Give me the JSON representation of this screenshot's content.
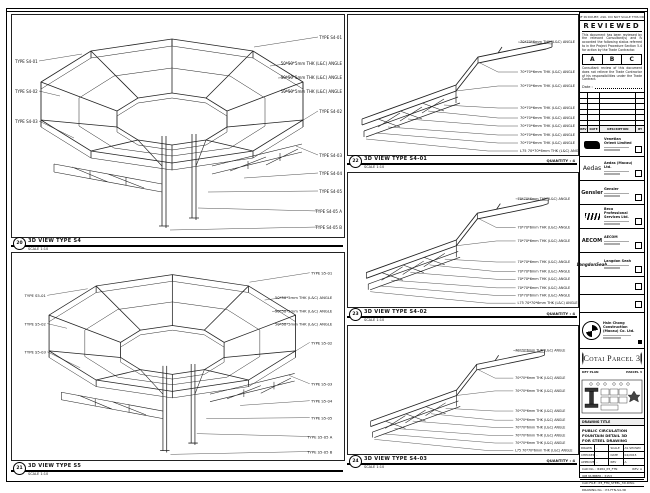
{
  "sheet": {
    "top_note": "IF IN DOUBT, ASK. DO NOT SCALE THIS DRAWING. ALL DIMENSIONS ARE IN MILLIMETRES."
  },
  "views": {
    "s4": {
      "ref": "20",
      "title": "3D VIEW TYPE S4",
      "scale": "SCALE 1:10",
      "left_labels": [
        "TYPE S4-01",
        "TYPE S4-02",
        "TYPE S4-03"
      ],
      "right_labels": [
        "TYPE S4-01",
        "50*50*5mm THK (L&C) ANGLE",
        "50*50*5mm THK (L&C) ANGLE",
        "50*50*5mm THK (L&C) ANGLE",
        "TYPE S4-02",
        "TYPE S4-03",
        "TYPE S4-04",
        "TYPE S4-05",
        "TYPE S4-05 A",
        "TYPE S4-05 B"
      ]
    },
    "s5": {
      "ref": "21",
      "title": "3D VIEW TYPE S5",
      "scale": "SCALE 1:10",
      "left_labels": [
        "TYPE S5-01",
        "TYPE S5-02",
        "TYPE S5-03"
      ],
      "right_labels": [
        "TYPE S5-01",
        "50*50*5mm THK (L&C) ANGLE",
        "50*50*5mm THK (L&C) ANGLE",
        "50*50*5mm THK (L&C) ANGLE",
        "TYPE S5-02",
        "TYPE S5-03",
        "TYPE S5-04",
        "TYPE S5-05",
        "TYPE S5-05 A",
        "TYPE S5-05 B"
      ]
    },
    "d1": {
      "ref": "22",
      "title": "3D VIEW TYPE S4-01",
      "scale": "SCALE 1:10",
      "quantity": "QUANTITY : 4"
    },
    "d2": {
      "ref": "23",
      "title": "3D VIEW TYPE S4-02",
      "scale": "SCALE 1:10",
      "quantity": "QUANTITY : 4"
    },
    "d3": {
      "ref": "24",
      "title": "3D VIEW TYPE S4-03",
      "scale": "SCALE 1:10",
      "quantity": "QUANTITY : 4"
    },
    "member_labels": [
      "70*70*6mm THK (L&C) ANGLE",
      "70*70*6mm THK (L&C) ANGLE",
      "70*70*6mm THK (L&C) ANGLE",
      "70*70*6mm THK (L&C) ANGLE",
      "70*70*6mm THK (L&C) ANGLE",
      "70*70*6mm THK (L&C) ANGLE",
      "70*70*6mm THK (L&C) ANGLE",
      "70*70*6mm THK (L&C) ANGLE",
      "L75 70*70*6mm THK (L&C) ANGLE"
    ]
  },
  "review": {
    "heading": "REVIEWED",
    "para1": "This document has been reviewed by the relevant Consultant(s) and is accorded the following status referred to in the Project Procedure Section 5.4 for action by the Trade Contractor.",
    "options": [
      "A",
      "B",
      "C"
    ],
    "para2": "Consultant review of this document does not relieve the Trade Contractor of his responsibilities under the Trade Contract.",
    "date_label": "Date :"
  },
  "revisions": {
    "headers": [
      "REV",
      "DATE",
      "DESCRIPTION",
      "BY"
    ]
  },
  "companies": [
    {
      "mark": "",
      "name": "Venetian Orient Limited"
    },
    {
      "mark": "Aedas",
      "name": "Aedas (Macau) Ltd."
    },
    {
      "mark": "Gensler",
      "name": "Gensler"
    },
    {
      "mark": "",
      "name": "Beca Professional Services Ltd."
    },
    {
      "mark": "AECOM",
      "name": "AECOM"
    },
    {
      "mark": "LangdonSeah",
      "name": "Langdon Seah"
    }
  ],
  "contractor": {
    "name": "Hsin Chong Construction (Macau) Co. Ltd."
  },
  "project": {
    "banner": "Cotai Parcel 3"
  },
  "keyplan": {
    "title": "KEY PLAN",
    "area": "PARCEL 3"
  },
  "titleblock": {
    "label": "DRAWING TITLE",
    "title_lines": [
      "PUBLIC CIRCULATION",
      "FOUNTAIN DETAIL 3D",
      "FOR STEEL DRAWING"
    ],
    "rows": [
      {
        "k1": "DRAWN",
        "v1": "-",
        "k2": "SCALE",
        "v2": "AS SHOWN"
      },
      {
        "k1": "CHECKED",
        "v1": "-",
        "k2": "DATE",
        "v2": "04/2015"
      },
      {
        "k1": "APPROVED",
        "v1": "-",
        "k2": "REV",
        "v2": "A"
      }
    ],
    "cad_row": "CAD No. : 8484_P3_FTN",
    "rev_note": "REV. A",
    "job_row": "JOB NUMBER : 3153",
    "file_row": "CAD FILE : P3_FTN_STEEL_3D.DWG",
    "dwg_row": "DRAWING No. : P3-FTN-S4-3D"
  }
}
